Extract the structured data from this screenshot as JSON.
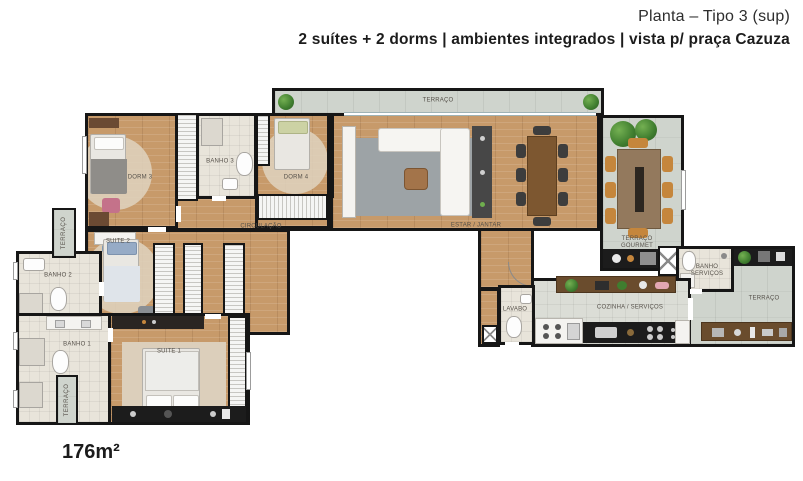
{
  "header": {
    "title": "Planta – Tipo 3 (sup)",
    "subtitle": "2 suítes + 2 dorms | ambientes integrados | vista p/ praça Cazuza"
  },
  "area_label": "176m²",
  "rooms": {
    "terraco_top": "TERRAÇO",
    "dorm3": "DORM 3",
    "banho3": "BANHO 3",
    "dorm4": "DORM 4",
    "circulacao": "CIRCULAÇÃO",
    "estar_jantar": "ESTAR / JANTAR",
    "terraco_gourmet": "TERRAÇO GOURMET",
    "banho_servicos": "BANHO SERVIÇOS",
    "terraco_right": "TERRAÇO",
    "cozinha_servicos": "COZINHA / SERVIÇOS",
    "lavabo": "LAVABO",
    "suite2": "SUITE 2",
    "banho2": "BANHO 2",
    "suite1": "SUITE 1",
    "banho1": "BANHO 1",
    "terraco_left_upper": "TERRAÇO",
    "terraco_left_lower": "TERRAÇO"
  },
  "colors": {
    "wall": "#161616",
    "wood_floor": "#c79a6a",
    "terrace_floor": "#cfd4cd",
    "bath_floor": "#e8e4da",
    "kitchen_floor": "#dbddd6",
    "plant_green": "#3f7d2f",
    "chair_tan": "#c5863c",
    "counter_black": "#1c1c1c",
    "rug_gray": "#9da3a6"
  }
}
